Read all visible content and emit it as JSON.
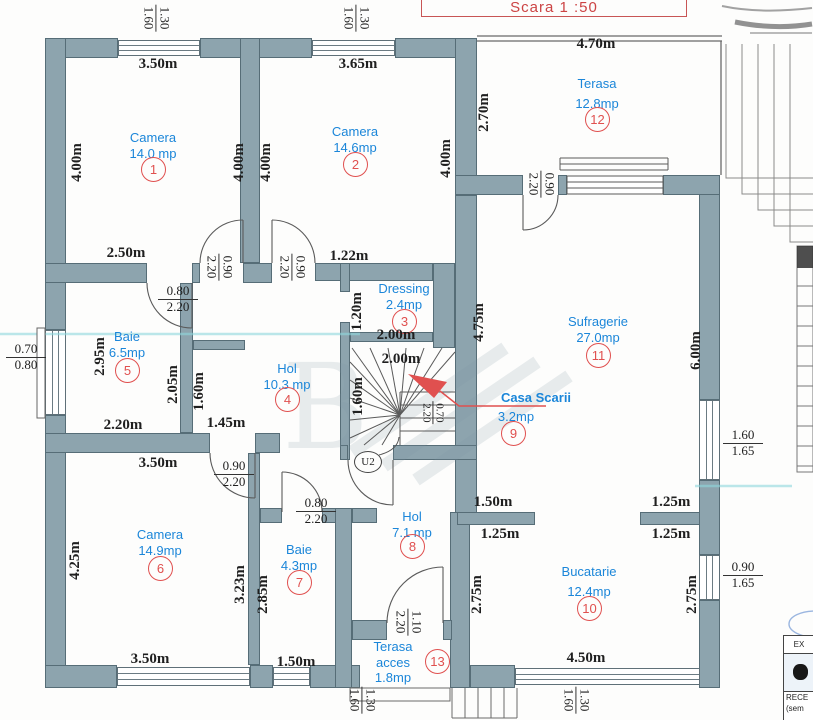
{
  "scale_box": {
    "label": "Scara  1 :50"
  },
  "colors": {
    "wall": "#8da4ae",
    "label_blue": "#1b86d9",
    "marker_red": "#e0504f",
    "dim_black": "#1f1f1f",
    "scale_red": "#cc4444"
  },
  "rooms": {
    "camera1": {
      "name": "Camera",
      "area": "14.0 mp",
      "num": "1"
    },
    "camera2": {
      "name": "Camera",
      "area": "14.6mp",
      "num": "2"
    },
    "dressing": {
      "name": "Dressing",
      "area": "2.4mp",
      "num": "3"
    },
    "hol4": {
      "name": "Hol",
      "area": "10.3 mp",
      "num": "4"
    },
    "baie5": {
      "name": "Baie",
      "area": "6.5mp",
      "num": "5"
    },
    "camera6": {
      "name": "Camera",
      "area": "14.9mp",
      "num": "6"
    },
    "baie7": {
      "name": "Baie",
      "area": "4.3mp",
      "num": "7"
    },
    "hol8": {
      "name": "Hol",
      "area": "7.1 mp",
      "num": "8"
    },
    "casa_scarii": {
      "name": "Casa Scarii",
      "area": "3.2mp",
      "num": "9"
    },
    "bucatarie": {
      "name": "Bucatarie",
      "area": "12.4mp",
      "num": "10"
    },
    "sufragerie": {
      "name": "Sufragerie",
      "area": "27.0mp",
      "num": "11"
    },
    "terasa12": {
      "name": "Terasa",
      "area": "12.8mp",
      "num": "12"
    },
    "terasa13": {
      "name": "Terasa",
      "name2": "acces",
      "area": "1.8mp",
      "num": "13"
    }
  },
  "dims": {
    "top_cam1": "3.50m",
    "top_cam2": "3.65m",
    "terasa_top": "4.70m",
    "terasa_left": "2.70m",
    "cam1_left": "4.00m",
    "cam1_right": "4.00m",
    "cam2_left": "4.00m",
    "cam2_right": "4.00m",
    "cam1_bottom": "2.50m",
    "cam2_bottom": "1.22m",
    "dressing_left": "1.20m",
    "dressing_bottom": "2.00m",
    "stair_top": "2.00m",
    "stair_left": "1.60m",
    "suf_left": "4.75m",
    "suf_right": "6.00m",
    "baie5_left": "2.95m",
    "baie5_mid": "2.05m",
    "hol4_left_v": "1.60m",
    "baie5_bottom": "2.20m",
    "hol4_bottom": "1.45m",
    "cam6_top": "3.50m",
    "cam6_left": "4.25m",
    "cam6_right": "3.23m",
    "baie7_left": "2.85m",
    "cam6_bottom": "3.50m",
    "baie7_bottom": "1.50m",
    "kit_tl": "1.50m",
    "kit_bl": "1.25m",
    "kit_tr": "1.25m",
    "kit_br": "1.25m",
    "kit_left": "2.75m",
    "kit_right": "2.75m",
    "kit_bottom": "4.50m"
  },
  "callouts": {
    "win_top1": {
      "t": "1.30",
      "b": "1.60"
    },
    "win_top2": {
      "t": "1.30",
      "b": "1.60"
    },
    "door_cam1": {
      "t": "0.90",
      "b": "2.20"
    },
    "door_cam2": {
      "t": "0.90",
      "b": "2.20"
    },
    "door_baie5": {
      "t": "0.80",
      "b": "2.20"
    },
    "win_left": {
      "t": "0.70",
      "b": "0.80"
    },
    "door_suf": {
      "t": "0.90",
      "b": "2.20"
    },
    "stair_door": {
      "t": "0.70",
      "b": "2.20"
    },
    "door_cam6": {
      "t": "0.90",
      "b": "2.20"
    },
    "door_baie7": {
      "t": "0.80",
      "b": "2.20"
    },
    "door_teracc": {
      "t": "1.10",
      "b": "2.20"
    },
    "win_right1": {
      "t": "1.60",
      "b": "1.65"
    },
    "win_right2": {
      "t": "0.90",
      "b": "1.65"
    },
    "win_bot1": {
      "t": "1.30",
      "b": "1.60"
    },
    "win_bot2": {
      "t": "1.30",
      "b": "1.60"
    }
  },
  "stair": {
    "label": "U2"
  },
  "titleblock": {
    "header": "EX",
    "line1": "RECE",
    "line2": "(sem"
  }
}
